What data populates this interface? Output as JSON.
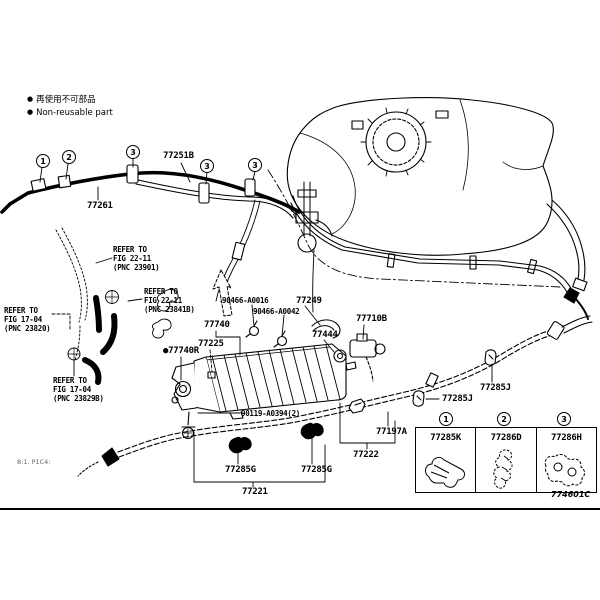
{
  "legend": {
    "bullet": "●",
    "nonreusable_jp": "再使用不可部品",
    "nonreusable_en": "Non-reusable part"
  },
  "parts": {
    "t77261": "77261",
    "t77251b": "77251B",
    "c77740": "77740",
    "f77225": "77225",
    "g77740r_prefix": "●",
    "g77740r": "77740R",
    "clip_a": "90466-A0016",
    "clip_b": "90466-A0042",
    "h77249": "77249",
    "g77444": "77444",
    "v77710b": "77710B",
    "j77285_a": "77285J",
    "j77285_b": "77285J",
    "c77197a": "77197A",
    "t77222": "77222",
    "t77221": "77221",
    "g77285g_a": "77285G",
    "g77285g_b": "77285G",
    "bolt": "90119-A0394(2)"
  },
  "references": {
    "ref1": {
      "l1": "REFER TO",
      "l2": "FIG 22-11",
      "l3": "(PNC 23901)"
    },
    "ref2": {
      "l1": "REFER TO",
      "l2": "FIG 22-11",
      "l3": "(PNC 23841B)"
    },
    "ref3": {
      "l1": "REFER TO",
      "l2": "FIG 17-04",
      "l3": "(PNC 23820)"
    },
    "ref4": {
      "l1": "REFER TO",
      "l2": "FIG 17-04",
      "l3": "(PNC 23829B)"
    }
  },
  "callouts": {
    "n1": "1",
    "n2": "2",
    "n3": "3"
  },
  "inset": {
    "cells": [
      {
        "num": "1",
        "part": "77285K"
      },
      {
        "num": "2",
        "part": "77286D"
      },
      {
        "num": "3",
        "part": "77286H"
      }
    ]
  },
  "footer": {
    "code": "774601C",
    "note": "8:1. P1C4:"
  }
}
